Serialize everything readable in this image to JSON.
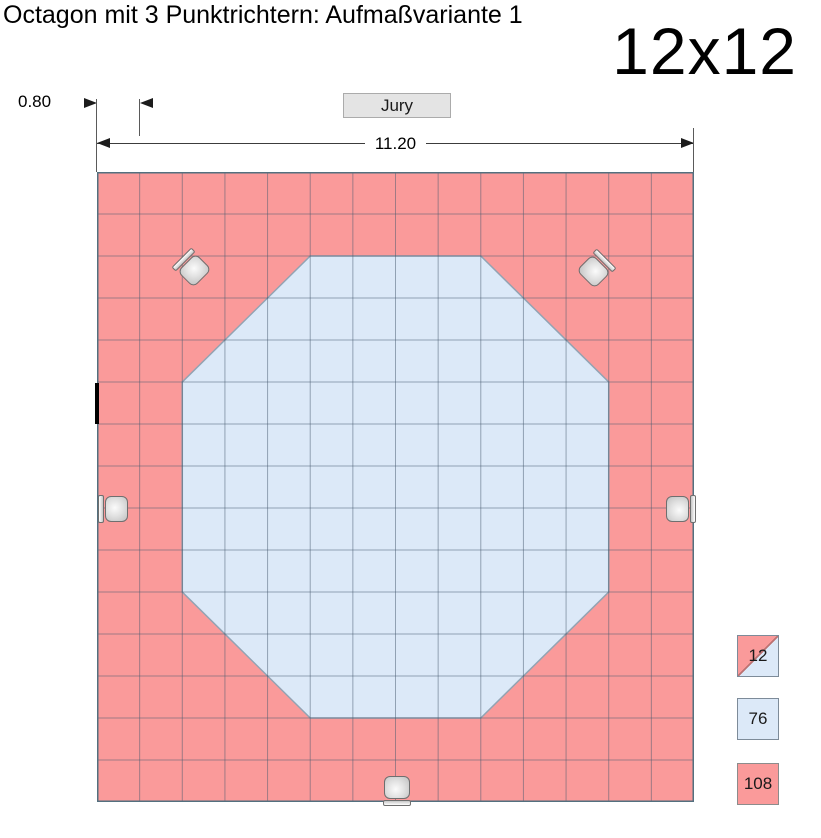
{
  "title": "Octagon mit 3 Punktrichtern: Aufmaßvariante 1",
  "size_label": "12x12",
  "jury": {
    "label": "Jury"
  },
  "dimensions": {
    "tile_width": "0.80",
    "mat_width": "11.20"
  },
  "colors": {
    "outer_red": "#FA9A9A",
    "inner_blue": "#DCE9F8",
    "grid_line": "rgba(70,90,110,0.5)",
    "grid_border": "#53707F",
    "octagon_edge": "#93A3B3"
  },
  "floor": {
    "cols": 14,
    "rows": 15,
    "octagon_cells": [
      [
        5,
        2
      ],
      [
        9,
        2
      ],
      [
        12,
        5
      ],
      [
        12,
        10
      ],
      [
        9,
        13
      ],
      [
        5,
        13
      ],
      [
        2,
        10
      ],
      [
        2,
        5
      ]
    ],
    "chairs": [
      {
        "id": "judge-chair-top-left",
        "cx": 95,
        "cy": 96,
        "rot": 45
      },
      {
        "id": "judge-chair-top-right",
        "cx": 499,
        "cy": 97,
        "rot": 135
      },
      {
        "id": "judge-chair-left",
        "cx": 16,
        "cy": 337,
        "rot": 0
      },
      {
        "id": "judge-chair-right",
        "cx": 584,
        "cy": 337,
        "rot": 180
      },
      {
        "id": "judge-chair-bottom",
        "cx": 300,
        "cy": 619,
        "rot": -90
      }
    ]
  },
  "legend": {
    "items": [
      {
        "value": "12",
        "type": "split",
        "meaning": "half red / half blue tiles"
      },
      {
        "value": "76",
        "type": "inner",
        "meaning": "blue octagon tiles"
      },
      {
        "value": "108",
        "type": "outer",
        "meaning": "red border tiles"
      }
    ]
  }
}
